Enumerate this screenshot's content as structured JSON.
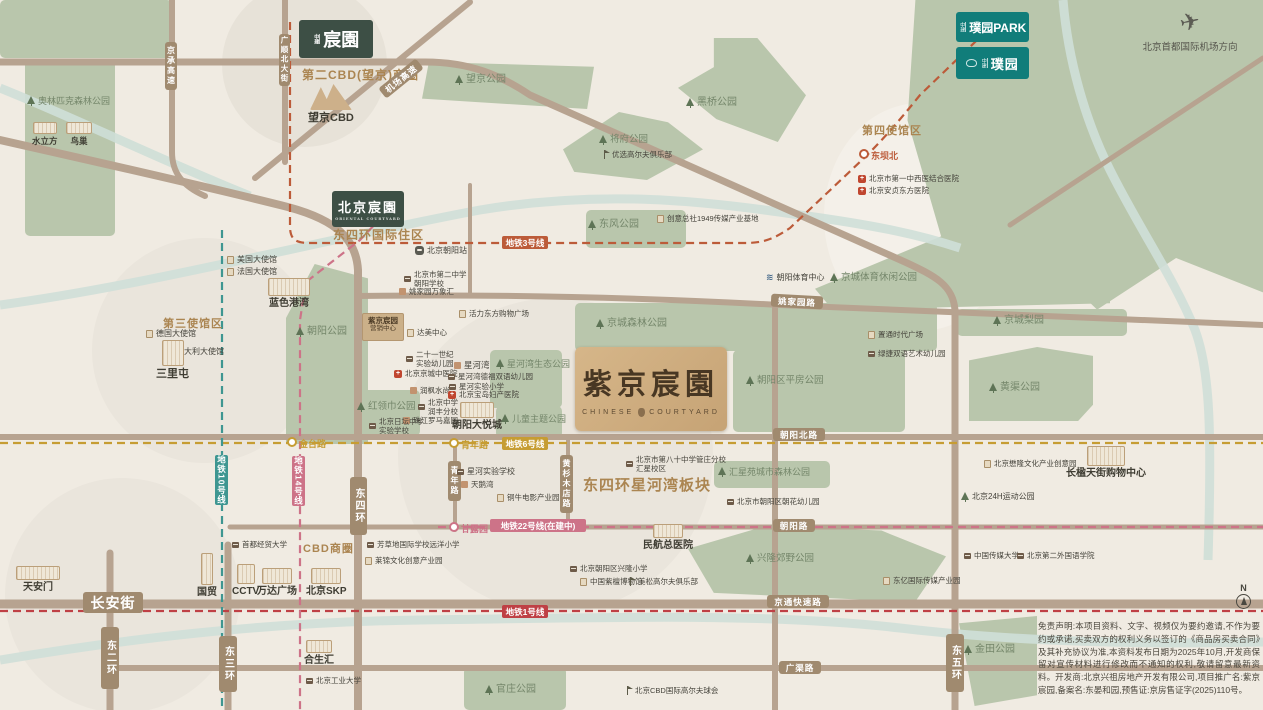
{
  "colors": {
    "bg": "#f0ebe2",
    "park": "#b9c6ac",
    "road": "#b7a390",
    "river": "#cfdfd8",
    "badge": "#a08a6f",
    "line1": "#bf4045",
    "line3": "#bc5b39",
    "line6": "#c69d33",
    "line10": "#3e9691",
    "line14": "#cd7388",
    "line22": "#cd7388",
    "logo_green": "#3d4f45",
    "logo_teal": "#117d7a",
    "property_tan": "#cfae82"
  },
  "logos": {
    "chenyuan": {
      "prefix": "中建",
      "name": "宸園"
    },
    "bj_chenyuan": {
      "prefix": "",
      "name": "北京宸園",
      "sub": "ORIENTAL COURTYARD"
    },
    "puyuan_park": {
      "prefix": "中建",
      "name": "璞园PARK"
    },
    "puyuan": {
      "prefix": "中建",
      "name": "璞园"
    }
  },
  "property": {
    "title": "紫京宸園",
    "sub_left": "CHINESE",
    "sub_right": "COURTYARD"
  },
  "marketing": {
    "line1": "紫京宸园",
    "line2": "营销中心"
  },
  "airport": {
    "label": "北京首都国际机场方向",
    "icon": "✈"
  },
  "compass": {
    "n": "N"
  },
  "disclaimer": {
    "text": "免责声明:本项目资料、文字、视频仅为要约邀请,不作为要约或承诺,买卖双方的权利义务以签订的《商品房买卖合同》及其补充协议为准,本资料发布日期为2025年10月,开发商保留对宣传材料进行修改而不通知的权利,敬请留意最新资料。开发商:北京兴祖房地产开发有限公司,项目推广名:紫京宸园,备案名:东晏和园,预售证:京房售证字(2025)110号。"
  },
  "zones": [
    {
      "x": 222,
      "y": -18,
      "w": 165,
      "h": 165,
      "c": "#e7e2d8"
    },
    {
      "x": 824,
      "y": 103,
      "w": 192,
      "h": 228,
      "c": "#f4f0e9"
    },
    {
      "x": 92,
      "y": 238,
      "w": 225,
      "h": 225,
      "c": "#eae5dc"
    },
    {
      "x": 398,
      "y": 298,
      "w": 315,
      "h": 315,
      "c": "#eae5dc"
    },
    {
      "x": 5,
      "y": 478,
      "w": 235,
      "h": 235,
      "c": "#eae5dc"
    }
  ],
  "parks": [
    {
      "x": 0,
      "y": 0,
      "w": 172,
      "h": 58
    },
    {
      "x": 25,
      "y": 60,
      "w": 90,
      "h": 176
    },
    {
      "x": 422,
      "y": 62,
      "w": 172,
      "h": 47,
      "clip": "polygon(4% 0,100% 10%,96% 100%,0 78%)"
    },
    {
      "x": 678,
      "y": 38,
      "w": 128,
      "h": 104,
      "clip": "polygon(28% 0,62% 0,100% 55%,78% 100%,30% 78%,0 48%,28% 28%)"
    },
    {
      "x": 563,
      "y": 112,
      "w": 140,
      "h": 68,
      "clip": "polygon(40% 0,75% 15%,100% 55%,60% 100%,8% 88%,0 55%)"
    },
    {
      "x": 868,
      "y": 0,
      "w": 395,
      "h": 430,
      "clip": "polygon(12% 0,100% 0,100% 68%,78% 60%,58% 72%,40% 56%,22% 66%,10% 28%)"
    },
    {
      "x": 586,
      "y": 210,
      "w": 100,
      "h": 38
    },
    {
      "x": 575,
      "y": 303,
      "w": 362,
      "h": 48
    },
    {
      "x": 733,
      "y": 350,
      "w": 172,
      "h": 82
    },
    {
      "x": 815,
      "y": 225,
      "w": 295,
      "h": 85,
      "clip": "polygon(0 75%,52% 0,100% 30%,100% 92%,6% 100%)"
    },
    {
      "x": 286,
      "y": 264,
      "w": 82,
      "h": 180,
      "clip": "polygon(35% 0,100% 8%,100% 100%,0 100%,0 30%)"
    },
    {
      "x": 352,
      "y": 390,
      "w": 68,
      "h": 46
    },
    {
      "x": 490,
      "y": 350,
      "w": 72,
      "h": 58
    },
    {
      "x": 496,
      "y": 406,
      "w": 66,
      "h": 32
    },
    {
      "x": 714,
      "y": 461,
      "w": 116,
      "h": 27
    },
    {
      "x": 688,
      "y": 526,
      "w": 258,
      "h": 76,
      "clip": "polygon(0 30%,30% 0,75% 6%,100% 40%,88% 100%,10% 88%)"
    },
    {
      "x": 464,
      "y": 667,
      "w": 102,
      "h": 43
    },
    {
      "x": 959,
      "y": 616,
      "w": 78,
      "h": 90,
      "clip": "polygon(0 8%,100% 0,100% 88%,20% 100%)"
    },
    {
      "x": 957,
      "y": 309,
      "w": 170,
      "h": 27
    },
    {
      "x": 969,
      "y": 347,
      "w": 124,
      "h": 74,
      "clip": "polygon(0 18%,55% 0,100% 12%,100% 78%,88% 100%,0 100%)"
    }
  ],
  "area_labels": [
    {
      "id": "second-cbd",
      "label": "第二CBD(望京)商圈",
      "x": 302,
      "y": 66,
      "s": 12
    },
    {
      "id": "dsh-intl",
      "label": "东四环国际住区",
      "x": 333,
      "y": 226,
      "s": 12
    },
    {
      "id": "third-embassy",
      "label": "第三使馆区",
      "x": 163,
      "y": 315,
      "s": 11
    },
    {
      "id": "fourth-embassy",
      "label": "第四使馆区",
      "x": 862,
      "y": 122,
      "s": 11
    },
    {
      "id": "cbd",
      "label": "CBD商圈",
      "x": 303,
      "y": 540,
      "s": 11
    },
    {
      "id": "xinghewan-block",
      "label": "东四环星河湾板块",
      "x": 583,
      "y": 474,
      "s": 15
    }
  ],
  "road_badges": [
    {
      "label": "长安街",
      "x": 83,
      "y": 592,
      "w": 60,
      "h": 21,
      "s": 14
    },
    {
      "label": "东二环",
      "x": 101,
      "y": 627,
      "w": 18,
      "h": 62,
      "v": true
    },
    {
      "label": "东三环",
      "x": 219,
      "y": 636,
      "w": 18,
      "h": 56,
      "v": true
    },
    {
      "label": "东四环",
      "x": 350,
      "y": 477,
      "w": 17,
      "h": 58,
      "v": true
    },
    {
      "label": "东五环",
      "x": 946,
      "y": 634,
      "w": 18,
      "h": 58,
      "v": true
    },
    {
      "label": "青年路",
      "x": 448,
      "y": 461,
      "w": 13,
      "h": 40,
      "v": true,
      "s": 8
    },
    {
      "label": "黄杉木店路",
      "x": 560,
      "y": 455,
      "w": 13,
      "h": 58,
      "v": true,
      "s": 8
    },
    {
      "label": "京承高速",
      "x": 165,
      "y": 42,
      "w": 12,
      "h": 48,
      "v": true,
      "s": 8
    },
    {
      "label": "广顺北大街",
      "x": 279,
      "y": 34,
      "w": 11,
      "h": 52,
      "v": true,
      "s": 7.5
    },
    {
      "label": "机场高速",
      "x": 377,
      "y": 72,
      "w": 48,
      "h": 13,
      "s": 8.5,
      "r": -39
    },
    {
      "label": "姚家园路",
      "x": 771,
      "y": 295,
      "w": 52,
      "h": 13,
      "s": 8.5,
      "r": 3
    },
    {
      "label": "朝阳北路",
      "x": 773,
      "y": 428,
      "w": 52,
      "h": 13,
      "s": 8.5
    },
    {
      "label": "朝阳路",
      "x": 773,
      "y": 519,
      "w": 42,
      "h": 13,
      "s": 8.5
    },
    {
      "label": "京通快速路",
      "x": 767,
      "y": 595,
      "w": 62,
      "h": 13,
      "s": 8.5
    },
    {
      "label": "广渠路",
      "x": 779,
      "y": 661,
      "w": 42,
      "h": 13,
      "s": 8.5
    }
  ],
  "metro_badges": [
    {
      "label": "地铁3号线",
      "x": 502,
      "y": 236,
      "w": 46,
      "h": 13,
      "c": "#bc5b39"
    },
    {
      "label": "地铁6号线",
      "x": 502,
      "y": 437,
      "w": 46,
      "h": 13,
      "c": "#c69d33"
    },
    {
      "label": "地铁22号线(在建中)",
      "x": 490,
      "y": 519,
      "w": 96,
      "h": 13,
      "c": "#cd7388"
    },
    {
      "label": "地铁1号线",
      "x": 502,
      "y": 605,
      "w": 46,
      "h": 13,
      "c": "#bf4045"
    },
    {
      "label": "地铁10号线",
      "x": 215,
      "y": 455,
      "w": 13,
      "h": 50,
      "c": "#3e9691",
      "v": true
    },
    {
      "label": "地铁14号线",
      "x": 292,
      "y": 456,
      "w": 13,
      "h": 50,
      "c": "#cd7388",
      "v": true
    }
  ],
  "stations": [
    {
      "label": "金台路",
      "x": 287,
      "y": 437,
      "c": "#c69d33"
    },
    {
      "label": "青年路",
      "x": 449,
      "y": 438,
      "c": "#c69d33"
    },
    {
      "label": "甘露园",
      "x": 449,
      "y": 522,
      "c": "#cd7388"
    },
    {
      "label": "东坝北",
      "x": 859,
      "y": 149,
      "c": "#bc5b39"
    }
  ],
  "pois": [
    {
      "id": "olympic-forest-park",
      "type": "tree",
      "x": 27,
      "y": 96,
      "label": "奥林匹克森林公园",
      "cls": "green",
      "s": 9
    },
    {
      "id": "water-cube",
      "type": "sketch",
      "x": 32,
      "y": 122,
      "label": "水立方",
      "layout": "col",
      "sw": 24,
      "sh": 12,
      "b": true,
      "s": 8.5
    },
    {
      "id": "birds-nest",
      "type": "sketch",
      "x": 66,
      "y": 122,
      "label": "鸟巢",
      "layout": "col",
      "sw": 26,
      "sh": 12,
      "b": true,
      "s": 8.5
    },
    {
      "id": "wangjing-park",
      "type": "tree",
      "x": 455,
      "y": 74,
      "label": "望京公园",
      "cls": "green",
      "s": 10
    },
    {
      "id": "heiqiao-park",
      "type": "tree",
      "x": 686,
      "y": 97,
      "label": "黑桥公园",
      "cls": "green",
      "s": 10
    },
    {
      "id": "jiangfu-park",
      "type": "tree",
      "x": 599,
      "y": 134,
      "label": "将府公园",
      "cls": "green",
      "s": 9.5
    },
    {
      "id": "youxuan-golf",
      "type": "flag",
      "x": 601,
      "y": 150,
      "label": "优选高尔夫俱乐部",
      "s": 7.5
    },
    {
      "id": "wangjing-cbd",
      "type": "mtn",
      "x": 308,
      "y": 84,
      "label": "望京CBD",
      "layout": "col",
      "sw": 42,
      "sh": 26,
      "b": true,
      "s": 11
    },
    {
      "id": "us-embassy",
      "type": "biz",
      "x": 227,
      "y": 255,
      "label": "美国大使馆",
      "s": 8
    },
    {
      "id": "fr-embassy",
      "type": "biz",
      "x": 227,
      "y": 267,
      "label": "法国大使馆",
      "s": 8
    },
    {
      "id": "de-embassy",
      "type": "biz",
      "x": 146,
      "y": 329,
      "label": "德国大使馆",
      "s": 8
    },
    {
      "id": "it-embassy",
      "type": "biz",
      "x": 166,
      "y": 347,
      "label": "意大利大使馆",
      "s": 8
    },
    {
      "id": "sanlitun",
      "type": "sketch",
      "x": 156,
      "y": 340,
      "label": "三里屯",
      "layout": "col",
      "sw": 22,
      "sh": 26,
      "b": true,
      "s": 11
    },
    {
      "id": "solana",
      "type": "sketch",
      "x": 268,
      "y": 278,
      "label": "蓝色港湾",
      "layout": "col",
      "sw": 42,
      "sh": 18,
      "b": true,
      "s": 10
    },
    {
      "id": "chaoyang-park",
      "type": "tree",
      "x": 296,
      "y": 326,
      "label": "朝阳公园",
      "cls": "green",
      "s": 10
    },
    {
      "id": "bj-chaoyang-station",
      "type": "train",
      "x": 415,
      "y": 246,
      "label": "北京朝阳站",
      "s": 8
    },
    {
      "id": "no2-middle-school",
      "type": "school",
      "x": 404,
      "y": 270,
      "label": "北京市第二中学",
      "label2": "朝阳学校",
      "s": 7.5
    },
    {
      "id": "yjy-mixc",
      "type": "res",
      "x": 399,
      "y": 287,
      "label": "姚家园万象汇",
      "s": 7.5
    },
    {
      "id": "huoli-mall",
      "type": "biz",
      "x": 459,
      "y": 309,
      "label": "活力东方购物广场",
      "s": 7.5
    },
    {
      "id": "damei-center",
      "type": "biz",
      "x": 407,
      "y": 328,
      "label": "达美中心",
      "s": 7.5
    },
    {
      "id": "21century-kind",
      "type": "school",
      "x": 406,
      "y": 350,
      "label": "二十一世纪",
      "label2": "实验幼儿园",
      "s": 7.5
    },
    {
      "id": "jingcheng-tcm",
      "type": "hosp",
      "x": 394,
      "y": 369,
      "label": "北京京城中医院",
      "s": 7.5
    },
    {
      "id": "runfeng",
      "type": "res",
      "x": 410,
      "y": 386,
      "label": "润枫水尚",
      "s": 7.5
    },
    {
      "id": "bj-zhongxue",
      "type": "school",
      "x": 418,
      "y": 398,
      "label": "北京中学",
      "label2": "润丰分校",
      "s": 7.5
    },
    {
      "id": "zhujiang-roma",
      "type": "res",
      "x": 403,
      "y": 416,
      "label": "珠江罗马嘉园",
      "s": 7.5
    },
    {
      "id": "ritan-school",
      "type": "school",
      "x": 369,
      "y": 417,
      "label": "北京日坛中学",
      "label2": "实验学校",
      "s": 7.5
    },
    {
      "id": "honglingjin-park",
      "type": "tree",
      "x": 357,
      "y": 401,
      "label": "红领巾公园",
      "cls": "green",
      "s": 9.5
    },
    {
      "id": "xinghewan",
      "type": "res",
      "x": 454,
      "y": 360,
      "label": "星河湾",
      "s": 8.5
    },
    {
      "id": "xhw-kindergarten",
      "type": "school",
      "x": 448,
      "y": 372,
      "label": "星河湾德福双语幼儿园",
      "s": 7.5
    },
    {
      "id": "xh-primary",
      "type": "school",
      "x": 449,
      "y": 382,
      "label": "星河实验小学",
      "s": 7.5
    },
    {
      "id": "baodao-hospital",
      "type": "hosp",
      "x": 448,
      "y": 390,
      "label": "北京宝岛妇产医院",
      "s": 7.5
    },
    {
      "id": "xhw-eco-park",
      "type": "tree",
      "x": 496,
      "y": 359,
      "label": "星河湾生态公园",
      "cls": "green",
      "s": 9
    },
    {
      "id": "joy-city",
      "type": "sketch",
      "x": 452,
      "y": 402,
      "label": "朝阳大悦城",
      "layout": "col",
      "sw": 34,
      "sh": 16,
      "b": true,
      "s": 10
    },
    {
      "id": "kids-theme-park",
      "type": "tree",
      "x": 501,
      "y": 414,
      "label": "儿童主题公园",
      "cls": "green",
      "s": 9
    },
    {
      "id": "jingcheng-forest",
      "type": "tree",
      "x": 596,
      "y": 318,
      "label": "京城森林公园",
      "cls": "green",
      "s": 10
    },
    {
      "id": "pingfang-park",
      "type": "tree",
      "x": 746,
      "y": 375,
      "label": "朝阳区平房公园",
      "cls": "green",
      "s": 9.5
    },
    {
      "id": "zhitong-plaza",
      "type": "biz",
      "x": 868,
      "y": 330,
      "label": "置通时代广场",
      "s": 7.5
    },
    {
      "id": "lvjie-kind",
      "type": "school",
      "x": 868,
      "y": 349,
      "label": "绿捷双语艺术幼儿园",
      "s": 7.5
    },
    {
      "id": "chuangyi-1949",
      "type": "biz",
      "x": 657,
      "y": 214,
      "label": "创意总社1949传媒产业基地",
      "s": 7.5
    },
    {
      "id": "dongfeng-park",
      "type": "tree",
      "x": 588,
      "y": 219,
      "label": "东风公园",
      "cls": "green",
      "s": 10
    },
    {
      "id": "cy-sports-center",
      "type": "swim",
      "x": 766,
      "y": 272,
      "label": "朝阳体育中心",
      "s": 8
    },
    {
      "id": "jc-sports-park",
      "type": "tree",
      "x": 830,
      "y": 272,
      "label": "京城体育休闲公园",
      "cls": "green",
      "s": 9.5
    },
    {
      "id": "first-tcm-hospital",
      "type": "hosp",
      "x": 858,
      "y": 174,
      "label": "北京市第一中西医结合医院",
      "s": 7.5
    },
    {
      "id": "anzhen-hospital",
      "type": "hosp",
      "x": 858,
      "y": 186,
      "label": "北京安贞东方医院",
      "s": 7.5
    },
    {
      "id": "huixing-park",
      "type": "tree",
      "x": 718,
      "y": 467,
      "label": "汇星苑城市森林公园",
      "cls": "green",
      "s": 9
    },
    {
      "id": "chaohua-kind",
      "type": "school",
      "x": 727,
      "y": 497,
      "label": "北京市朝阳区朝花幼儿园",
      "s": 7.5
    },
    {
      "id": "no80-school",
      "type": "school",
      "x": 626,
      "y": 455,
      "label": "北京市第八十中学管庄分校",
      "label2": "汇星校区",
      "s": 7.5
    },
    {
      "id": "minhang-hospital",
      "type": "sketch",
      "x": 643,
      "y": 524,
      "label": "民航总医院",
      "layout": "col",
      "sw": 30,
      "sh": 14,
      "b": true,
      "s": 10
    },
    {
      "id": "xinglong-country-park",
      "type": "tree",
      "x": 746,
      "y": 553,
      "label": "兴隆郊野公园",
      "cls": "green",
      "s": 9.5
    },
    {
      "id": "xinghe-exp-school",
      "type": "school",
      "x": 457,
      "y": 467,
      "label": "星河实验学校",
      "s": 8
    },
    {
      "id": "tianewan",
      "type": "res",
      "x": 461,
      "y": 480,
      "label": "天鹅湾",
      "s": 7.5
    },
    {
      "id": "tongniu-film",
      "type": "biz",
      "x": 497,
      "y": 493,
      "label": "铜牛电影产业园",
      "s": 7.5
    },
    {
      "id": "fangcaodi-school",
      "type": "school",
      "x": 367,
      "y": 540,
      "label": "芳草地国际学校远洋小学",
      "s": 7.5
    },
    {
      "id": "laijin-culture",
      "type": "biz",
      "x": 365,
      "y": 556,
      "label": "莱锦文化创意产业园",
      "s": 7.5
    },
    {
      "id": "shoujingmao-univ",
      "type": "school",
      "x": 232,
      "y": 540,
      "label": "首都经贸大学",
      "s": 7.5
    },
    {
      "id": "xinglong-primary",
      "type": "school",
      "x": 570,
      "y": 564,
      "label": "北京朝阳区兴隆小学",
      "s": 7.5
    },
    {
      "id": "zitan-museum",
      "type": "biz",
      "x": 580,
      "y": 577,
      "label": "中国紫檀博物馆",
      "s": 7.5
    },
    {
      "id": "meisong-golf",
      "type": "flag",
      "x": 627,
      "y": 577,
      "label": "美松高尔夫俱乐部",
      "s": 7.5
    },
    {
      "id": "cbd-golf",
      "type": "flag",
      "x": 624,
      "y": 686,
      "label": "北京CBD国际高尔夫球会",
      "s": 7.5
    },
    {
      "id": "guanzhuang-park",
      "type": "tree",
      "x": 485,
      "y": 684,
      "label": "官庄公园",
      "cls": "green",
      "s": 10
    },
    {
      "id": "dongyi-media",
      "type": "biz",
      "x": 883,
      "y": 576,
      "label": "东亿国际传媒产业园",
      "s": 7.5
    },
    {
      "id": "cuc-univ",
      "type": "school",
      "x": 964,
      "y": 551,
      "label": "中国传媒大学",
      "s": 7.5
    },
    {
      "id": "bisu-univ",
      "type": "school",
      "x": 1017,
      "y": 551,
      "label": "北京第二外国语学院",
      "s": 7.5
    },
    {
      "id": "maolong-culture",
      "type": "biz",
      "x": 984,
      "y": 459,
      "label": "北京懋隆文化产业创意园",
      "s": 7.5
    },
    {
      "id": "changying-mall",
      "type": "sketch",
      "x": 1066,
      "y": 446,
      "label": "长楹天街购物中心",
      "layout": "col",
      "sw": 38,
      "sh": 20,
      "b": true,
      "s": 10
    },
    {
      "id": "24h-sports-park",
      "type": "tree",
      "x": 961,
      "y": 492,
      "label": "北京24H运动公园",
      "s": 8
    },
    {
      "id": "jintian-park",
      "type": "tree",
      "x": 964,
      "y": 644,
      "label": "金田公园",
      "cls": "green",
      "s": 10
    },
    {
      "id": "bjut-univ",
      "type": "school",
      "x": 306,
      "y": 676,
      "label": "北京工业大学",
      "s": 7.5
    },
    {
      "id": "hopson-one",
      "type": "sketch",
      "x": 304,
      "y": 640,
      "label": "合生汇",
      "layout": "col",
      "sw": 26,
      "sh": 13,
      "b": true,
      "s": 10
    },
    {
      "id": "guomao",
      "type": "sketch",
      "x": 197,
      "y": 553,
      "label": "国贸",
      "layout": "col",
      "sw": 12,
      "sh": 32,
      "b": true,
      "s": 10
    },
    {
      "id": "cctv",
      "type": "sketch",
      "x": 232,
      "y": 564,
      "label": "CCTV",
      "layout": "col",
      "sw": 18,
      "sh": 20,
      "b": true,
      "s": 10
    },
    {
      "id": "wanda-plaza",
      "type": "sketch",
      "x": 257,
      "y": 568,
      "label": "万达广场",
      "layout": "col",
      "sw": 30,
      "sh": 16,
      "b": true,
      "s": 10
    },
    {
      "id": "beijing-skp",
      "type": "sketch",
      "x": 306,
      "y": 568,
      "label": "北京SKP",
      "layout": "col",
      "sw": 30,
      "sh": 16,
      "b": true,
      "s": 10
    },
    {
      "id": "tiananmen",
      "type": "sketch",
      "x": 16,
      "y": 566,
      "label": "天安门",
      "layout": "col",
      "sw": 44,
      "sh": 14,
      "b": true,
      "s": 10
    },
    {
      "id": "jingcheng-liyuan",
      "type": "tree",
      "x": 993,
      "y": 315,
      "label": "京城梨园",
      "cls": "green",
      "s": 10
    },
    {
      "id": "huangqu-park",
      "type": "tree",
      "x": 989,
      "y": 382,
      "label": "黄渠公园",
      "cls": "green",
      "s": 10
    }
  ]
}
